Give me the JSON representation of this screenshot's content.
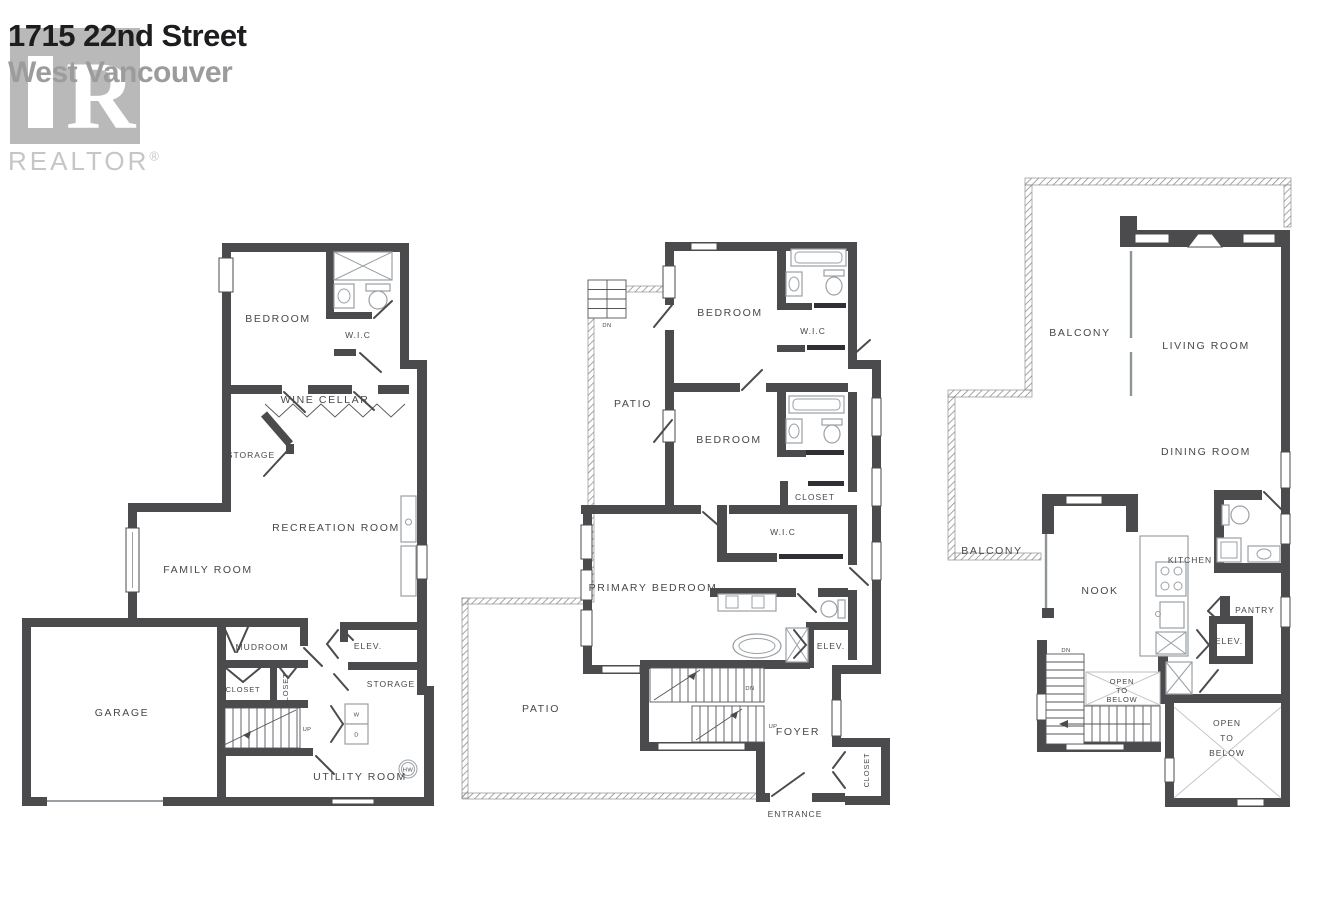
{
  "header": {
    "title": "1715 22nd Street",
    "subtitle": "West Vancouver",
    "brand": "REALTOR",
    "brand_mark": "®",
    "logo_letter": "R"
  },
  "palette": {
    "wall": "#4b4b4d",
    "label_text": "#47484a",
    "fixture_line": "#9aa0a4",
    "hatch_line": "#8f8f8f",
    "title_text": "#1d1d1f",
    "subtitle_text": "#9c9c9c",
    "brand_text": "#c6c6c6",
    "logo_block": "#b9b9b9"
  },
  "plans": {
    "basement": {
      "bedroom": "BEDROOM",
      "wic": "W.I.C",
      "wine_cellar": "WINE CELLAR",
      "storage_upper": "STORAGE",
      "recreation_room": "RECREATION ROOM",
      "family_room": "FAMILY ROOM",
      "mudroom": "MUDROOM",
      "closet_a": "CLOSET",
      "closet_b": "CLOSET",
      "elevator": "ELEV.",
      "storage_lower": "STORAGE",
      "garage": "GARAGE",
      "utility_room": "UTILITY ROOM",
      "stairs_up": "UP",
      "washer": "W",
      "dryer": "D",
      "hot_water": "HW"
    },
    "main": {
      "bedroom_upper": "BEDROOM",
      "wic_upper": "W.I.C",
      "patio_upper": "PATIO",
      "bedroom_lower": "BEDROOM",
      "closet": "CLOSET",
      "wic_lower": "W.I.C",
      "primary_bedroom": "PRIMARY BEDROOM",
      "elevator": "ELEV.",
      "patio_lower": "PATIO",
      "foyer": "FOYER",
      "entrance": "ENTRANCE",
      "closet_entry": "CLOSET",
      "stairs_dn_exterior": "DN",
      "stairs_dn": "DN",
      "stairs_up": "UP"
    },
    "upper": {
      "balcony_upper": "BALCONY",
      "living_room": "LIVING ROOM",
      "dining_room": "DINING ROOM",
      "balcony_lower": "BALCONY",
      "nook": "NOOK",
      "kitchen": "KITCHEN",
      "pantry": "PANTRY",
      "elevator": "ELEV.",
      "open_to_below_small": [
        "OPEN",
        "TO",
        "BELOW"
      ],
      "open_to_below_large": [
        "OPEN",
        "TO",
        "BELOW"
      ],
      "stairs_dn": "DN"
    }
  }
}
